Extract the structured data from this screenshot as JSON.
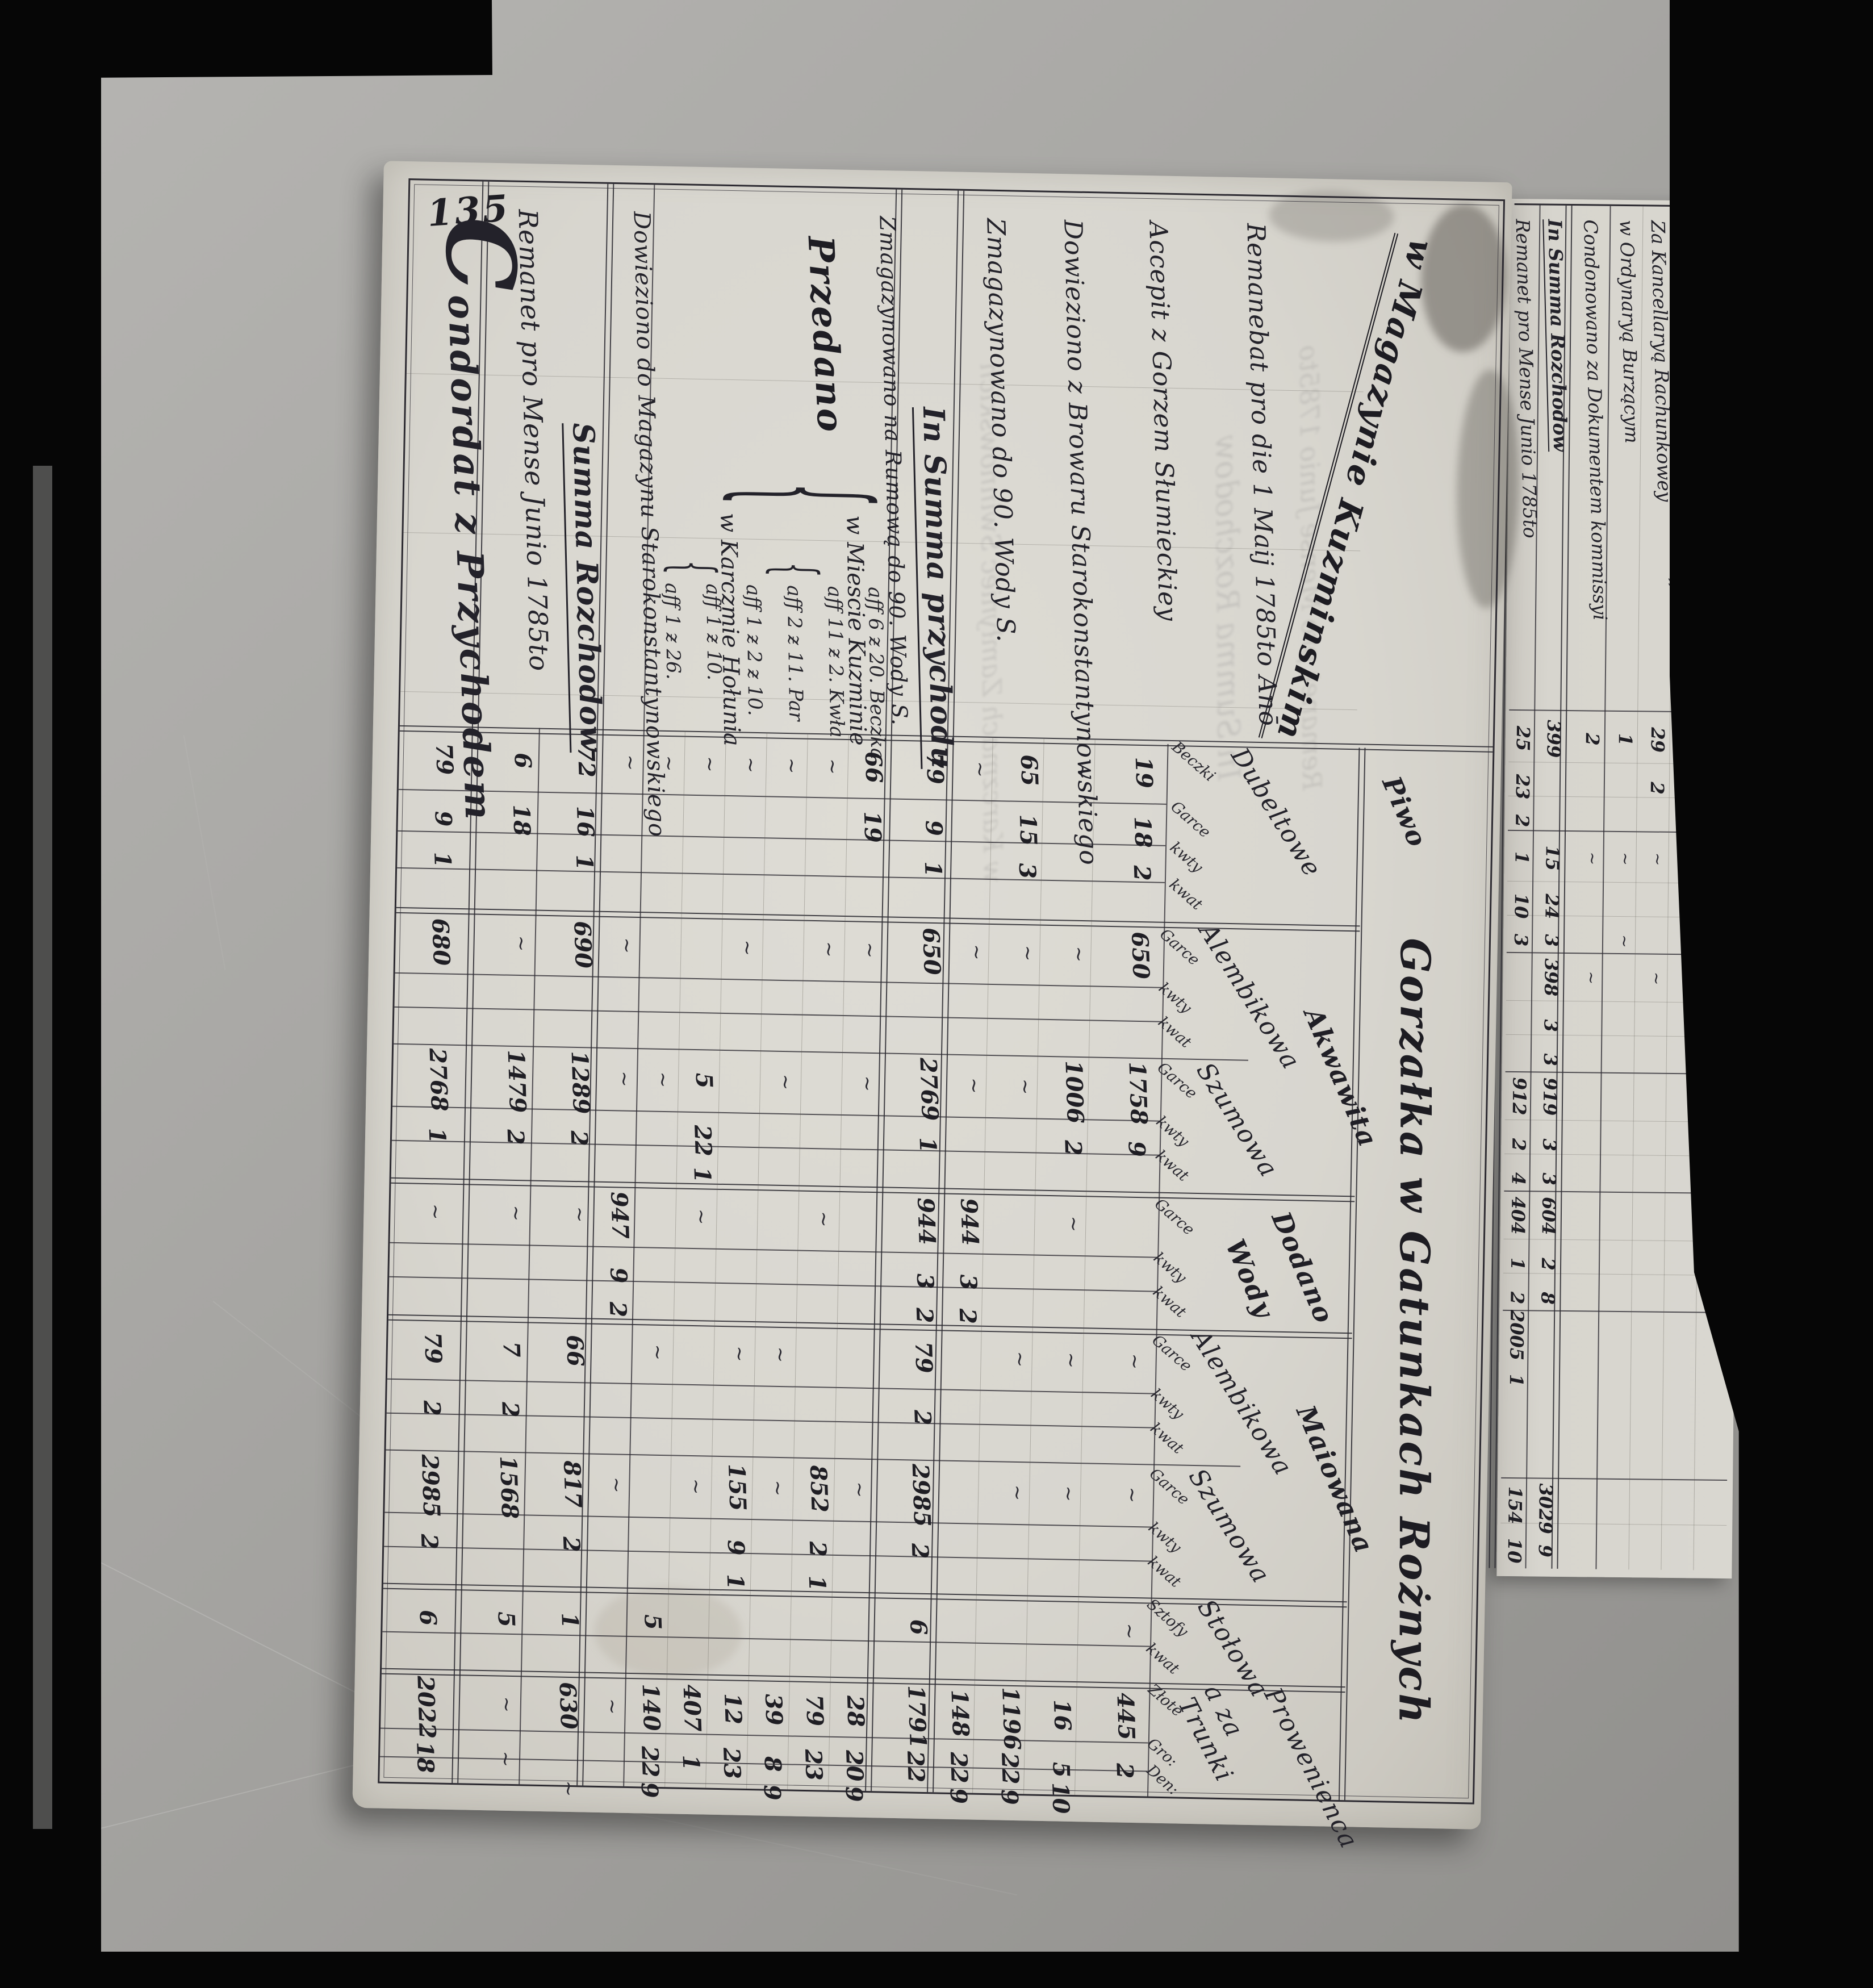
{
  "page_number": "135",
  "title": "w Magazynie Kuzminskim",
  "colors": {
    "film": "#060606",
    "background": "#a7a6a2",
    "paper": "#dad8d1",
    "ink": "#23222a"
  },
  "marks": {
    "ditto": "∼",
    "dash": "—",
    "brace": "{"
  },
  "header": {
    "big": "Gorzałka w Gatunkach Rożnych",
    "beer": {
      "group": "Piwo",
      "name": "Dubeltowe",
      "cols": [
        "Beczki",
        "Garce",
        "kwty",
        "kwat"
      ]
    },
    "akwawita": {
      "name": "Akwawita",
      "alemb": "Alembikowa",
      "szum": "Szumowa"
    },
    "dodano": {
      "name1": "Dodano",
      "name2": "Wody"
    },
    "maiowana": {
      "name": "Maiowana",
      "alemb": "Alembikowa",
      "szum": "Szumowa"
    },
    "stolowa": {
      "name": "Stołowa",
      "cols": [
        "Sztofy",
        "kwat"
      ]
    },
    "money": {
      "name1": "Prowenienca",
      "name2": "a za Trunki",
      "cols": [
        "Złote",
        "Gro:",
        "Den:"
      ]
    },
    "unit_garce": "Garce",
    "unit_kwty": "kwty",
    "unit_kwat": "kwat"
  },
  "rows": [
    {
      "label": "Remanebat pro die 1 Maij 1785to Anō",
      "cells": [
        "19",
        "18",
        "2",
        "650",
        "1758",
        "9",
        "445",
        "2"
      ]
    },
    {
      "label": "Accepit z Gorzem Słumieckiey",
      "cells": [
        "1006",
        "2",
        "16",
        "5",
        "10"
      ]
    },
    {
      "label": "Dowieziono z Browaru Starokonstantynowskiego",
      "cells": [
        "65",
        "15",
        "3",
        "1196",
        "22",
        "9"
      ]
    },
    {
      "label": "Zmagazynowano do 90. Wody S.",
      "cells": [
        "944",
        "3",
        "2",
        "148",
        "22",
        "9"
      ]
    },
    {
      "label": "In Summa przychodu",
      "cells": [
        "79",
        "9",
        "1",
        "650",
        "2769",
        "1",
        "944",
        "3",
        "2",
        "79",
        "2",
        "2985",
        "2",
        "6",
        "1791",
        "22"
      ]
    },
    {
      "label": "Zmagazynowano na Rumową do 90. Wody S.",
      "cells": []
    },
    {
      "word": "Przedano",
      "dest1": "w Miescie Kuzminie",
      "dest2": "w Karczmie Hołunia",
      "prices": [
        {
          "label": "aff 6 ƶ 20. Beczka",
          "cells": [
            "66",
            "19",
            "28",
            "20",
            "9"
          ]
        },
        {
          "label": "aff 11 ƶ 2. Kwła",
          "cells": [
            "852",
            "2",
            "1",
            "79",
            "23"
          ]
        },
        {
          "label": "aff 2 ƶ 11. Par",
          "cells": [
            "39",
            "8",
            "9"
          ]
        },
        {
          "label": "aff 1 ƶ 2 ƶ 10.",
          "cells": [
            "155",
            "9",
            "1",
            "12",
            "23"
          ]
        },
        {
          "label": "aff 1 ƶ 10.",
          "cells": [
            "5",
            "22",
            "1",
            "407",
            "1"
          ]
        },
        {
          "label": "aff 1 ƶ 26.",
          "cells": [
            "5",
            "140",
            "22",
            "9"
          ]
        }
      ]
    },
    {
      "label": "Dowieziono do Magazynu Starokonstantynowskiego",
      "cells": [
        "947",
        "9",
        "2"
      ]
    },
    {
      "label": "Summa Rozchodow",
      "cells": [
        "72",
        "16",
        "1",
        "690",
        "1289",
        "2",
        "66",
        "817",
        "2",
        "1",
        "630"
      ]
    },
    {
      "label": "Remanet pro Mense Junio 1785to",
      "cells": [
        "6",
        "18",
        "1479",
        "2",
        "7",
        "2",
        "1568",
        "5"
      ]
    },
    {
      "label": "Condordat z Przychodem",
      "cells": [
        "79",
        "9",
        "1",
        "680",
        "2768",
        "1",
        "79",
        "2",
        "2985",
        "2",
        "6",
        "2022",
        "18"
      ]
    }
  ],
  "ghost": [
    "Remanet pro Mense Junio 1785to",
    "In Summa Rozchodow",
    "w Karczmach Zamłyniec Swinnowskich"
  ],
  "second_page": {
    "rows": [
      {
        "label": "w Karczmach",
        "sublabel": "Zamłyniec / Swinnowskich  aff 2 ƶ 9 20",
        "cells": [
          "28",
          "8",
          "16",
          "3",
          "24",
          "3"
        ]
      },
      {
        "label": "w Sufficyencya Wgo JmP. Stolnika Lutkiego",
        "sublabel": "aff 6 ƶ 20 Beczka",
        "cells": []
      },
      {
        "label": "Za Kancellaryą Rachunkowey",
        "sublabel": "",
        "cells": [
          "29",
          "2"
        ]
      },
      {
        "label": "w Ordynaryą Burzącym",
        "sublabel": "",
        "cells": [
          "1"
        ]
      },
      {
        "label": "Condonowano za Dokumentem kommissyi",
        "sublabel": "",
        "cells": [
          "2"
        ]
      },
      {
        "label": "In Summa Rozchodow",
        "sublabel": "",
        "cells": [
          "399",
          "15",
          "24",
          "3",
          "398",
          "3",
          "3",
          "919",
          "3",
          "3",
          "604",
          "2",
          "8",
          "3029",
          "9"
        ]
      },
      {
        "label": "Remanet pro Mense Junio 1785to",
        "sublabel": "",
        "cells": [
          "25",
          "23",
          "2",
          "1",
          "10",
          "3",
          "912",
          "2",
          "4",
          "404",
          "1",
          "2",
          "2005",
          "1",
          "154",
          "10"
        ]
      }
    ]
  }
}
